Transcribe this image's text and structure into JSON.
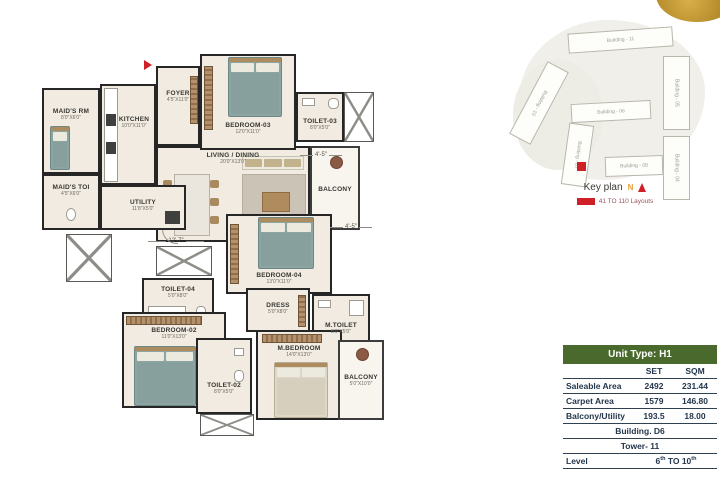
{
  "floor_plan": {
    "rooms": [
      {
        "name": "MAID'S RM",
        "dims": "8'0\"X6'0\""
      },
      {
        "name": "MAID'S TOI",
        "dims": "4'5\"X6'0\""
      },
      {
        "name": "KITCHEN",
        "dims": "10'0\"X11'0\""
      },
      {
        "name": "UTILITY",
        "dims": "11'8\"X5'0\""
      },
      {
        "name": "FOYER",
        "dims": "4'5\"X11'0\""
      },
      {
        "name": "BEDROOM-03",
        "dims": "12'0\"X11'0\""
      },
      {
        "name": "TOILET-03",
        "dims": "8'0\"X5'0\""
      },
      {
        "name": "LIVING / DINING",
        "dims": "20'0\"X13'0\""
      },
      {
        "name": "BALCONY",
        "dims": ""
      },
      {
        "name": "BEDROOM-04",
        "dims": "13'0\"X11'0\""
      },
      {
        "name": "TOILET-04",
        "dims": "5'0\"X8'0\""
      },
      {
        "name": "DRESS",
        "dims": "5'0\"X8'0\""
      },
      {
        "name": "M.TOILET",
        "dims": "8'0\"X5'0\""
      },
      {
        "name": "BEDROOM-02",
        "dims": "11'0\"X13'0\""
      },
      {
        "name": "TOILET-02",
        "dims": "8'0\"X5'0\""
      },
      {
        "name": "M.BEDROOM",
        "dims": "14'0\"X13'0\""
      },
      {
        "name": "BALCONY",
        "dims": "5'0\"X10'0\""
      }
    ],
    "dimension_labels": [
      "12'-7\"",
      "4'-5\"",
      "4'-5\""
    ]
  },
  "key_plan": {
    "title": "Key plan",
    "north_label": "N",
    "legend_label": "41 TO 110 Layouts",
    "buildings": [
      "Building - 11",
      "Building - 10",
      "Building - 06",
      "Building - 05",
      "Building - 04",
      "Building - 08",
      "Building - 07"
    ]
  },
  "info_table": {
    "header": "Unit Type: H1",
    "col_set": "SET",
    "col_sqm": "SQM",
    "rows": [
      {
        "label": "Saleable Area",
        "set": "2492",
        "sqm": "231.44"
      },
      {
        "label": "Carpet Area",
        "set": "1579",
        "sqm": "146.80"
      },
      {
        "label": "Balcony/Utility",
        "set": "193.5",
        "sqm": "18.00"
      }
    ],
    "building_row": "Building. D6",
    "tower_row": "Tower- 11",
    "level_label": "Level",
    "level_parts": [
      "6",
      "th",
      " TO 10",
      "th"
    ]
  },
  "colors": {
    "accent_green": "#4a6a2d",
    "marker_red": "#cf2027",
    "gold": "#c29b3d"
  }
}
